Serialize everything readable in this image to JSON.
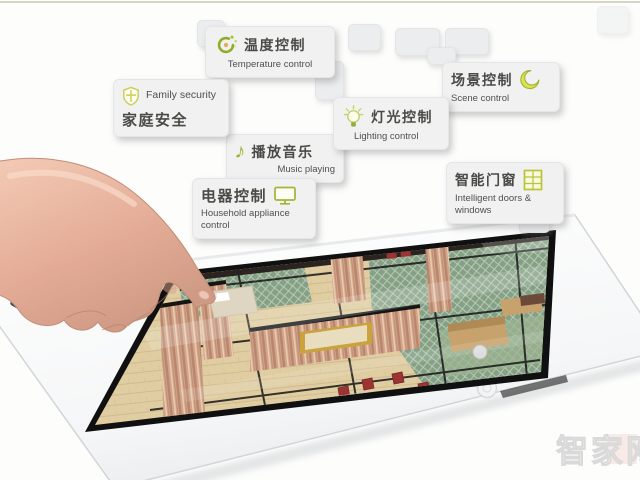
{
  "page": {
    "background": "#fdfdfc",
    "top_divider_color": "#d6d6c6"
  },
  "cards": [
    {
      "id": "temperature-control",
      "zh": "温度控制",
      "en": "Temperature control",
      "icon": "sun-swirl-icon"
    },
    {
      "id": "family-security",
      "zh": "家庭安全",
      "en": "Family security",
      "icon": "shield-cross-icon"
    },
    {
      "id": "scene-control",
      "zh": "场景控制",
      "en": "Scene control",
      "icon": "moon-icon"
    },
    {
      "id": "lighting-control",
      "zh": "灯光控制",
      "en": "Lighting control",
      "icon": "light-bulb-icon"
    },
    {
      "id": "music-playing",
      "zh": "播放音乐",
      "en": "Music playing",
      "icon": "music-note-icon"
    },
    {
      "id": "household-appliance-control",
      "zh": "电器控制",
      "en": "Household appliance control",
      "icon": "tv-monitor-icon"
    },
    {
      "id": "intelligent-doors-windows",
      "zh": "智能门窗",
      "en": "Intelligent doors & windows",
      "icon": "window-icon"
    }
  ],
  "icons": {
    "music_note_glyph": "♪"
  },
  "watermark": {
    "text": "智家网"
  },
  "colors": {
    "accent_green": "#a3b437",
    "card_background": "#f1f1f2",
    "carpet_green": "#85a086",
    "wall_wood": "#d2a489",
    "chair_red": "#9c3433",
    "hand_skin": "#e9bba6",
    "tablet_body": "#ffffff"
  }
}
